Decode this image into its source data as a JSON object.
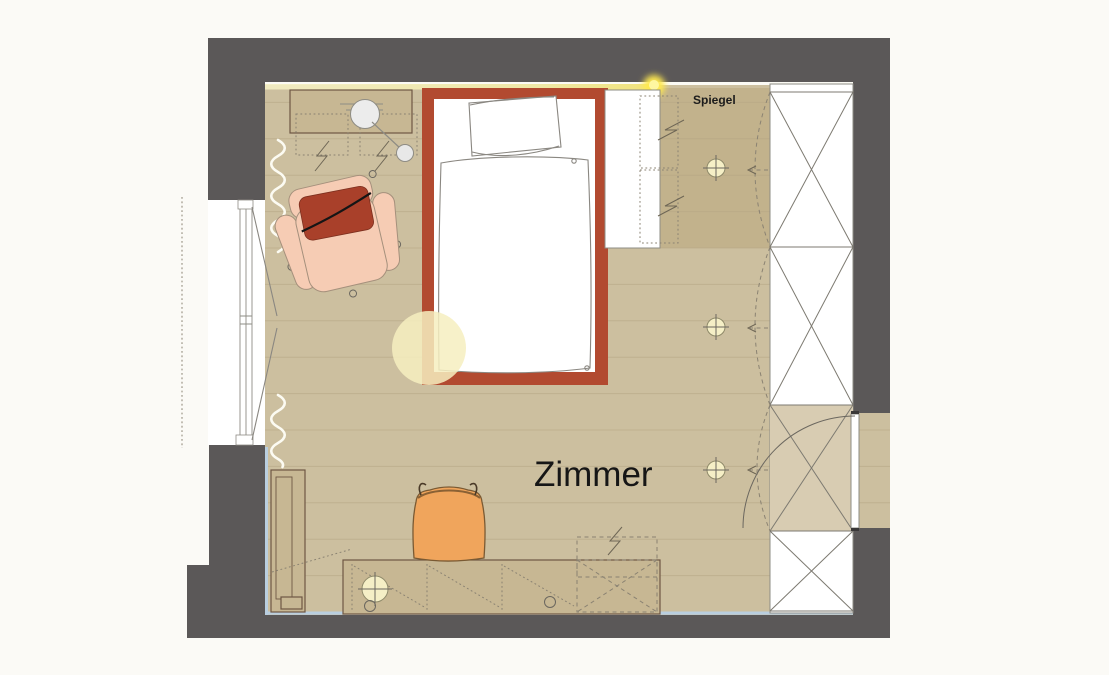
{
  "labels": {
    "room_name": "Zimmer",
    "mirror": "Spiegel"
  },
  "colors": {
    "background": "#fbfaf6",
    "wall": "#5b5858",
    "floor": "#ccbf9f",
    "floor_line": "#b5a685",
    "mirror_zone": "#c2b28c",
    "furniture_tan": "#c7b793",
    "furniture_border": "#6e5744",
    "wardrobe_tint": "#d8ccb2",
    "bed_frame_red": "#b24a30",
    "armchair_pink": "#f6ccb4",
    "cushion_red": "#a9402a",
    "chair_orange": "#f0a55c",
    "light_cream": "#f5efc6",
    "led_strip": "#efe8ac",
    "led_glow": "#ffe94f",
    "wardrobe_line": "#7d7a71",
    "wall_liner_blue": "#b9cedf",
    "sketch_line": "#8a8781"
  },
  "furniture_semantics": [
    "bed",
    "pillow",
    "duvet",
    "reading-light-glow",
    "armchair",
    "sideboard",
    "pendant-lamp",
    "wall-cabinets-dashed",
    "white-cabinet",
    "wardrobe",
    "wardrobe-door-swings",
    "mirror-zone",
    "ceiling-spotlights",
    "room-door",
    "door-swing-arc",
    "window",
    "curtains",
    "shelf-cabinet",
    "desk",
    "desk-lamp",
    "cable-grommets",
    "rollcontainer-dashed",
    "desk-chair",
    "led-strip"
  ]
}
